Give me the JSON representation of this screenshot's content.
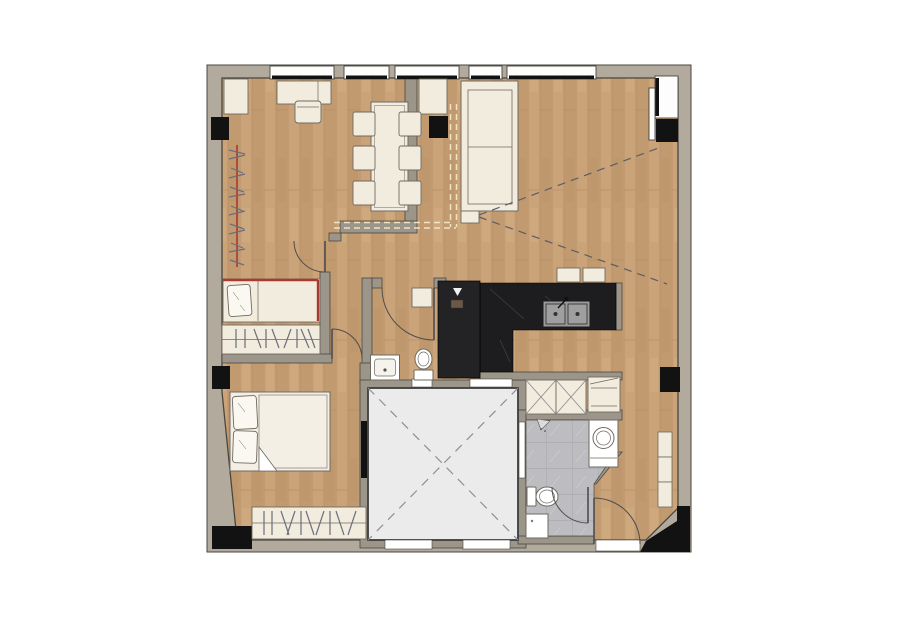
{
  "canvas": {
    "width": 900,
    "height": 636
  },
  "palette": {
    "bg": "#ffffff",
    "wall_band": "#b1aa9d",
    "wall_fill": "#9c968a",
    "wall_line": "#4a463f",
    "column": "#121212",
    "wood_a": "#cba379",
    "wood_b": "#c29a70",
    "wood_line": "#b18c63",
    "furniture": "#f2ecdf",
    "furniture_line": "#6f6a60",
    "accent_red": "#a93a30",
    "kitchen_dark": "#1d1d1f",
    "sink_gray": "#9b9b9b",
    "tile": "#bdbdc1",
    "tile_line": "#a3a3a8",
    "core_fill": "#ebebeb",
    "core_line": "#3d3d3d",
    "dash_gray": "#8f8f8f",
    "sight": "#5c5c64",
    "ceiling_dash": "#efe3c4",
    "door": "#4d4d4d",
    "glass": "#fdfdfd",
    "black_bar": "#111111",
    "shower_dark": "#232325"
  },
  "plan": {
    "type": "apartment-floor-plan",
    "window_count": 6,
    "door_count": 5,
    "rooms": [
      {
        "name": "study-bedroom",
        "features": [
          "corner-cabinet",
          "desk",
          "desk-chair",
          "clothes-rail",
          "single-bed-red-trim",
          "wardrobe"
        ]
      },
      {
        "name": "living-dining",
        "features": [
          "sideboard",
          "dining-table",
          "six-dining-chairs",
          "sofa",
          "side-table",
          "wall-tv",
          "tv-sight-lines",
          "ceiling-dash-outline",
          "bar-stools"
        ]
      },
      {
        "name": "kitchen",
        "features": [
          "l-shaped-dark-counter",
          "double-sink",
          "tall-unit",
          "x-front-cabinets",
          "appliance-unit"
        ]
      },
      {
        "name": "wc-shower-room",
        "features": [
          "dark-shower",
          "shower-head",
          "washbasin",
          "toilet",
          "wall-shelf"
        ]
      },
      {
        "name": "master-bedroom",
        "features": [
          "double-bed",
          "two-pillows",
          "blanket-fold",
          "wardrobe",
          "riser-panel"
        ]
      },
      {
        "name": "bathroom",
        "features": [
          "tiled-floor",
          "washing-machine",
          "toilet",
          "base-cabinet",
          "shower-head"
        ]
      },
      {
        "name": "entry-hall",
        "features": [
          "wall-shelves",
          "entry-door"
        ]
      },
      {
        "name": "elevator-core",
        "features": [
          "dashed-x-shaft",
          "service-panels"
        ]
      }
    ]
  }
}
